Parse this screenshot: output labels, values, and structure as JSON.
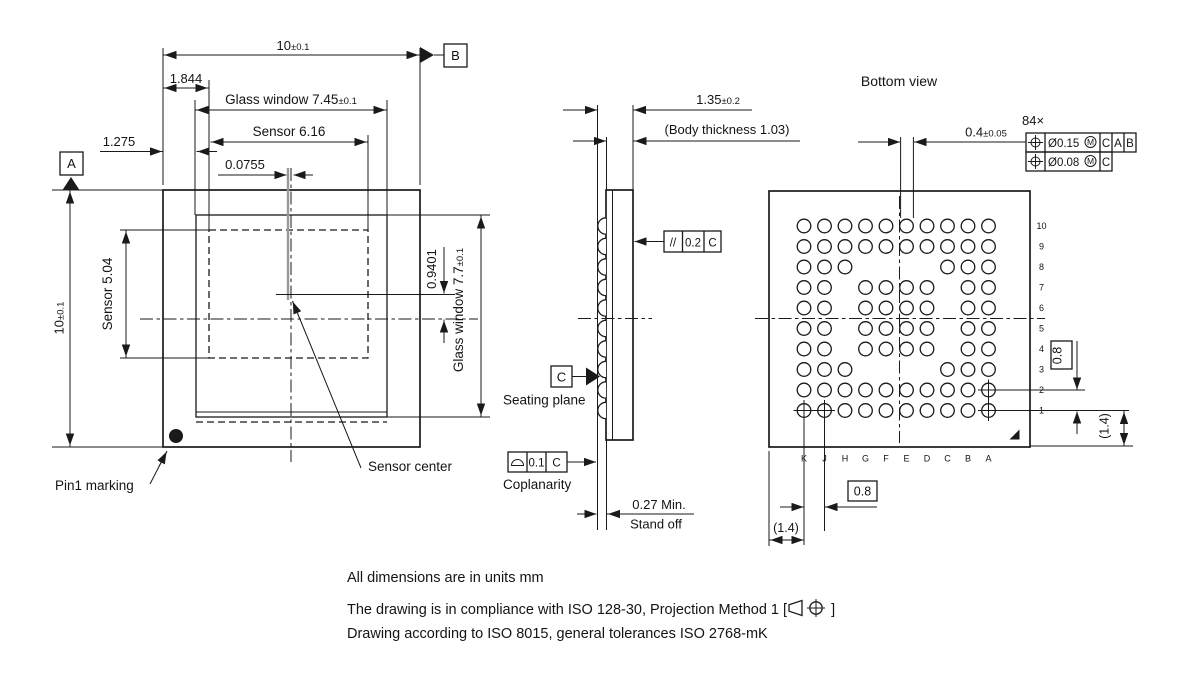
{
  "top_view": {
    "width_dim": {
      "v": "10",
      "tol": "±0.1"
    },
    "offset_top": "1.844",
    "glass_width": {
      "label": "Glass window 7.45",
      "tol": "±0.1"
    },
    "sensor_width": "Sensor 6.16",
    "offset_left": "1.275",
    "center_offset_x": "0.0755",
    "height_dim": {
      "v": "10",
      "tol": "±0.1"
    },
    "sensor_height": "Sensor 5.04",
    "center_offset_y": "0.9401",
    "glass_height": {
      "label": "Glass window 7.7",
      "tol": "±0.1"
    },
    "datum_a": "A",
    "datum_b": "B",
    "pin1_label": "Pin1 marking",
    "sensor_center_label": "Sensor center"
  },
  "side_view": {
    "thickness": {
      "v": "1.35",
      "tol": "±0.2"
    },
    "body_thickness": "(Body thickness 1.03)",
    "parallelism": {
      "sym": "//",
      "val": "0.2",
      "ref": "C"
    },
    "datum_c": "C",
    "seating_label": "Seating plane",
    "coplanarity": {
      "val": "0.1",
      "ref": "C",
      "label": "Coplanarity"
    },
    "standoff_value": "0.27 Min.",
    "standoff_label": "Stand off"
  },
  "bottom_view": {
    "title": "Bottom view",
    "ball_dia": {
      "v": "0.4",
      "tol": "±0.05"
    },
    "ball_count": "84×",
    "fcf1": {
      "dia": "Ø0.15",
      "mod": "M",
      "d1": "C",
      "d2": "A",
      "d3": "B"
    },
    "fcf2": {
      "dia": "Ø0.08",
      "mod": "M",
      "d1": "C"
    },
    "pitch_row": "0.8",
    "pitch_col": "0.8",
    "edge_row": "(1.4)",
    "edge_col": "(1.4)",
    "columns": [
      "K",
      "J",
      "H",
      "G",
      "F",
      "E",
      "D",
      "C",
      "B",
      "A"
    ],
    "rows": [
      "10",
      "9",
      "8",
      "7",
      "6",
      "5",
      "4",
      "3",
      "2",
      "1"
    ],
    "ball_rows": [
      "KJHGFEDCBA",
      "KJHGFEDCBA",
      "KJHCBA",
      "KJGFEDBA",
      "KJGFEDBA",
      "KJGFEDBA",
      "KJGFEDBA",
      "KJHCBA",
      "KJHGFEDCBA",
      "KJHGFEDCBA"
    ],
    "datum_balls": [
      "A1",
      "A2",
      "K1",
      "J1"
    ]
  },
  "notes": {
    "line1": "All dimensions are in units mm",
    "line2_prefix": "The drawing is in compliance with ISO 128-30, Projection Method 1 [",
    "line2_suffix": "]",
    "line3": "Drawing according to ISO 8015, general tolerances ISO 2768-mK"
  },
  "colors": {
    "line": "#1a1a1a",
    "gray_centerline": "#999999",
    "background": "#ffffff"
  }
}
